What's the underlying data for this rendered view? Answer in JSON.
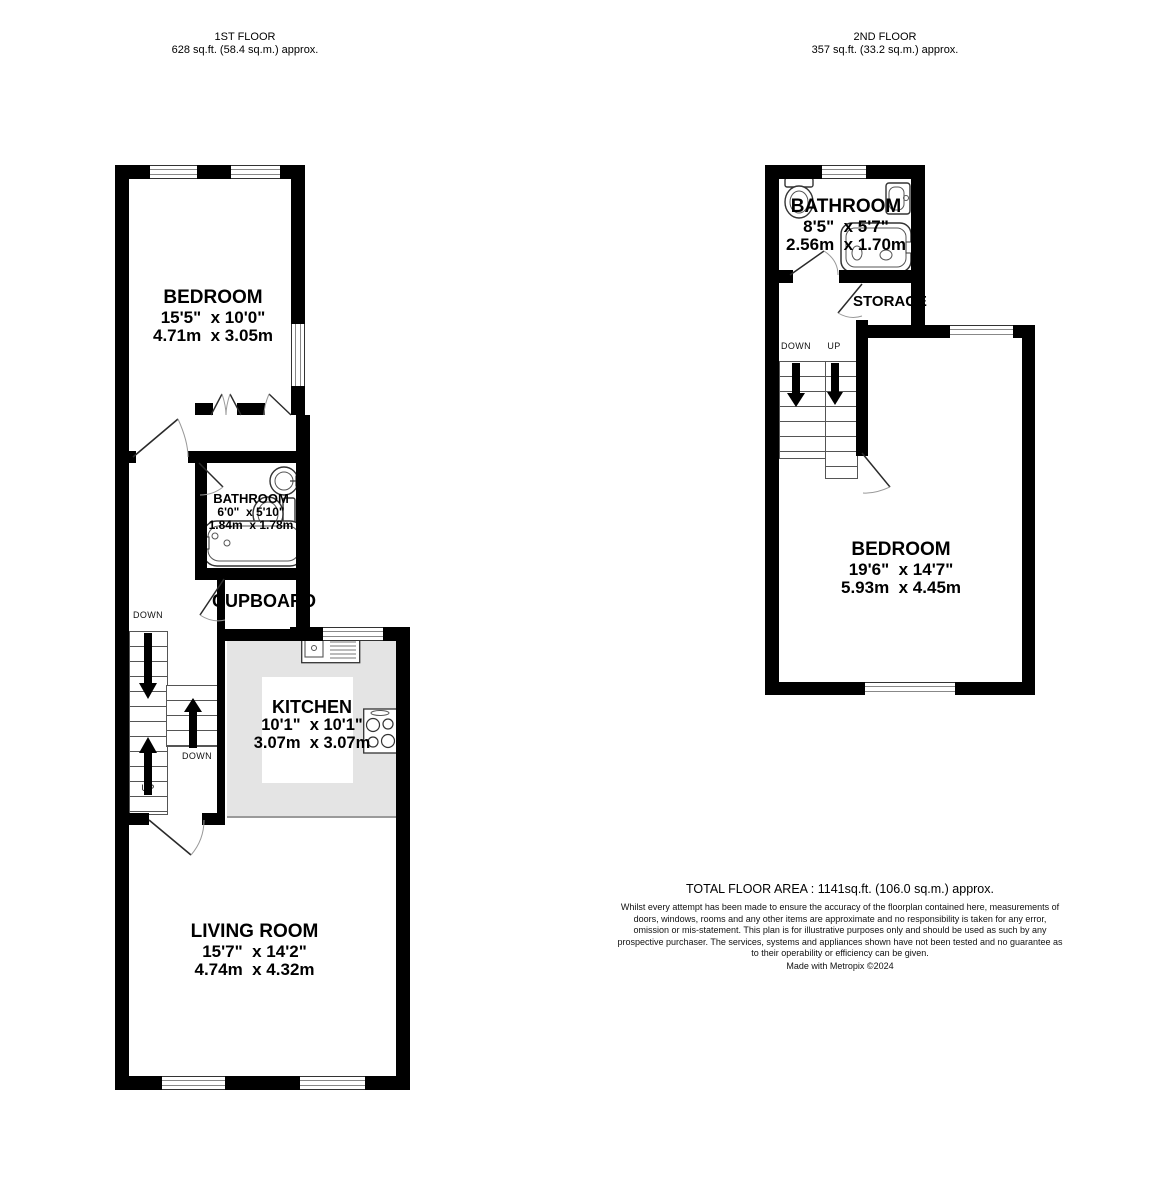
{
  "first_floor": {
    "title": "1ST FLOOR",
    "area": "628 sq.ft. (58.4 sq.m.) approx.",
    "bedroom": {
      "name": "BEDROOM",
      "imperial": "15'5\"  x 10'0\"",
      "metric": "4.71m  x 3.05m"
    },
    "bathroom": {
      "name": "BATHROOM",
      "imperial": "6'0\"  x 5'10\"",
      "metric": "1.84m  x 1.78m"
    },
    "cupboard_label": "CUPBOARD",
    "kitchen": {
      "name": "KITCHEN",
      "imperial": "10'1\"  x 10'1\"",
      "metric": "3.07m  x 3.07m"
    },
    "living_room": {
      "name": "LIVING ROOM",
      "imperial": "15'7\"  x 14'2\"",
      "metric": "4.74m  x 4.32m"
    },
    "stair_labels": {
      "top": "DOWN",
      "bottom": "UP",
      "right": "DOWN"
    }
  },
  "second_floor": {
    "title": "2ND FLOOR",
    "area": "357 sq.ft. (33.2 sq.m.) approx.",
    "bathroom": {
      "name": "BATHROOM",
      "imperial": "8'5\"  x 5'7\"",
      "metric": "2.56m  x 1.70m"
    },
    "storage_label": "STORAGE",
    "bedroom": {
      "name": "BEDROOM",
      "imperial": "19'6\"  x 14'7\"",
      "metric": "5.93m  x 4.45m"
    },
    "stair_labels": {
      "left": "DOWN",
      "right": "UP"
    }
  },
  "footer": {
    "total_area": "TOTAL FLOOR AREA : 1141sq.ft. (106.0 sq.m.) approx.",
    "disclaimer": "Whilst every attempt has been made to ensure the accuracy of the floorplan contained here, measurements of doors, windows, rooms and any other items are approximate and no responsibility is taken for any error, omission or mis-statement. This plan is for illustrative purposes only and should be used as such by any prospective purchaser. The services, systems and appliances shown have not been tested and no guarantee as to their operability or efficiency can be given.",
    "credit": "Made with Metropix ©2024"
  },
  "colors": {
    "wall": "#000000",
    "kitchen_floor": "#e4e4e4",
    "window_line": "#888888"
  }
}
